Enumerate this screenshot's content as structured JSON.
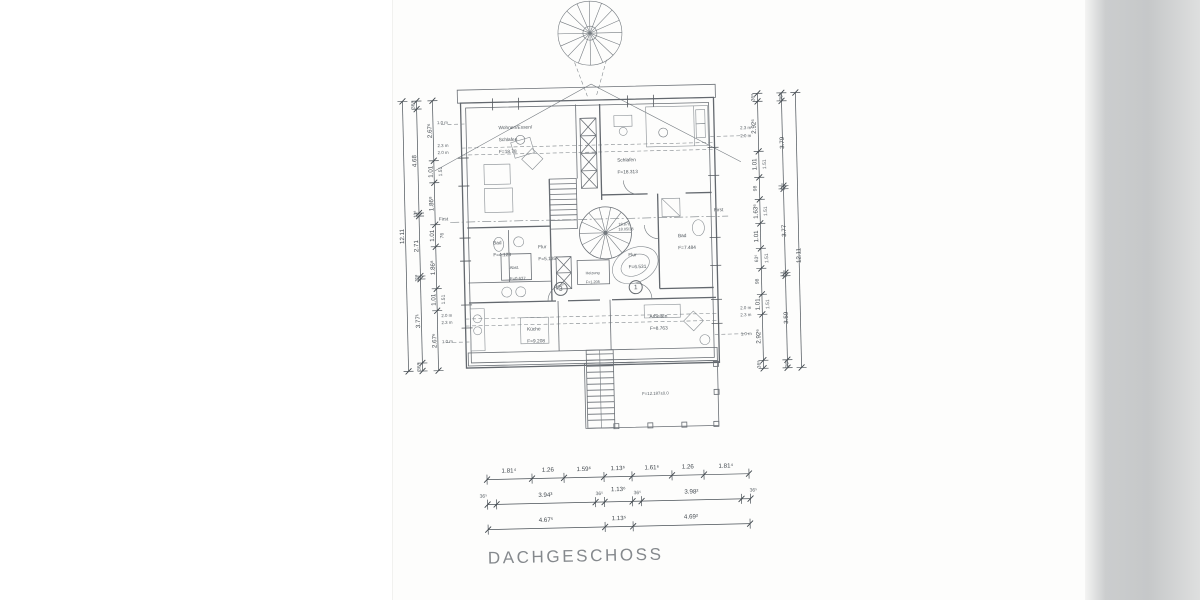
{
  "title": "DACHGESCHOSS",
  "rooms": {
    "wohnen": {
      "name": "Wohnen/Essen/",
      "name2": "Schlafen",
      "area": "F=18.78"
    },
    "schlafen": {
      "name": "Schlafen",
      "area": "F=18.313"
    },
    "bad_links": {
      "name": "Bad",
      "area": "F=4.123"
    },
    "flur_links": {
      "name": "Flur",
      "area": "F=5.135"
    },
    "abst": {
      "name": "Abst.",
      "area": "F=0.637"
    },
    "heizung": {
      "name": "Heizung",
      "area": "F=1.205"
    },
    "flur_rechts": {
      "name": "Flur",
      "area": "F=6.531"
    },
    "bad_rechts": {
      "name": "Bad",
      "area": "F=7.484"
    },
    "kueche": {
      "name": "Küche",
      "area": "F=9.208"
    },
    "arbeiten": {
      "name": "Arbeiten",
      "area": "F=8.763"
    }
  },
  "stair_note": {
    "line1": "18.876",
    "line2": "18.05/38"
  },
  "terrace_label": "F=12.187±0.0",
  "unit_numbers": {
    "left": "3",
    "right": "1"
  },
  "ridge_label": "First",
  "height_marks": {
    "left": [
      "1.0 m",
      "2.3 m",
      "2.0 m",
      "2.0 m",
      "2.3 m",
      "1.0 m"
    ],
    "right": [
      "2.3 m",
      "2.0 m",
      "2.0 m",
      "2.3 m",
      "1.0 m"
    ]
  },
  "dims": {
    "left_total": "12.11",
    "left_outer": [
      "36⁸",
      "4.68",
      "11⁸",
      "2.71",
      "11⁸",
      "3.77¹",
      "36⁸"
    ],
    "left_inner": [
      "2.67⁶",
      "1.01",
      "1.86⁸",
      "1.01",
      "1.86⁸",
      "1.01",
      "2.67⁶"
    ],
    "left_inner_secondary": [
      "1.51",
      "76",
      "1.51"
    ],
    "right_inner": [
      "36⁸",
      "2.92⁶",
      "1.01",
      "98",
      "1.63⁶",
      "1.01",
      "63⁶",
      "98",
      "1.01",
      "2.92⁶",
      "36⁸"
    ],
    "right_inner_secondary": [
      "1.51",
      "1.51",
      "1.51",
      "1.51"
    ],
    "right_outer": [
      "36⁸",
      "3.79",
      "11⁸",
      "3.77",
      "11⁸",
      "3.59",
      "36⁸"
    ],
    "right_total": "12.11",
    "bottom_row1": [
      "1.81⁴",
      "1.26",
      "1.59⁶",
      "1.13⁶",
      "1.61⁶",
      "1.26",
      "1.81⁴"
    ],
    "bottom_row2": [
      "36⁵",
      "3.94³",
      "36⁵",
      "1.13⁶",
      "36⁵",
      "3.98²",
      "36⁵"
    ],
    "bottom_row3": [
      "4.67⁵",
      "1.13⁵",
      "4.69²"
    ]
  }
}
